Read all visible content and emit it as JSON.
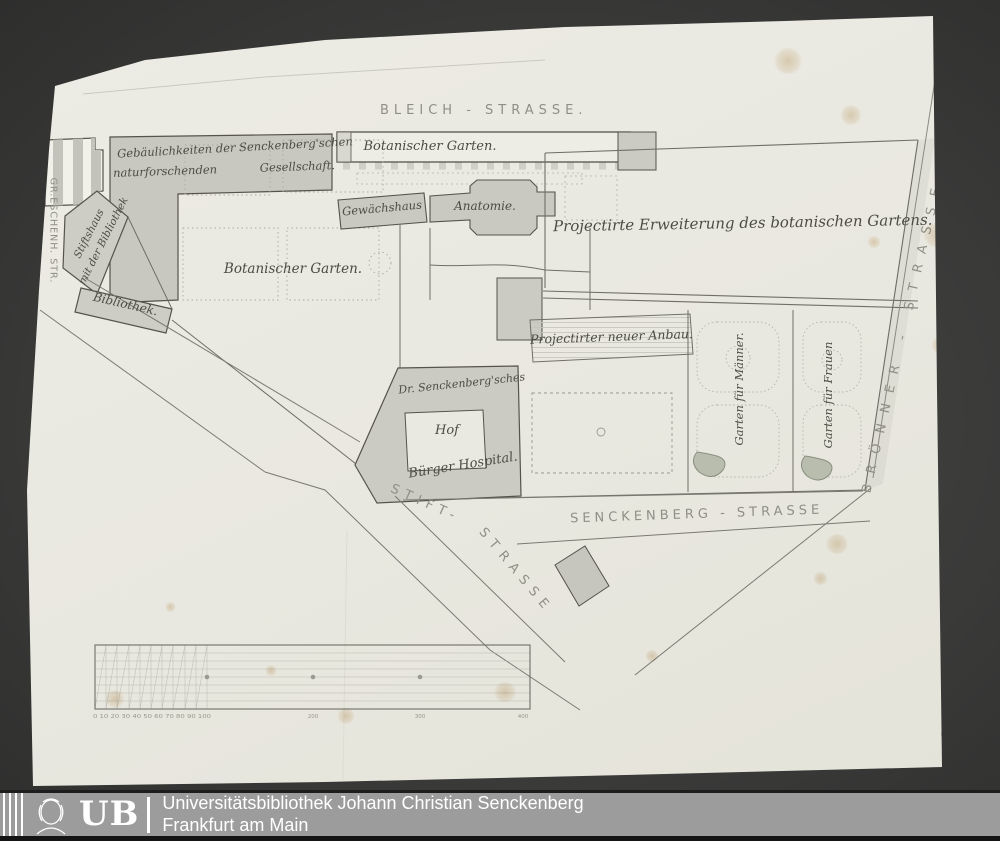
{
  "map": {
    "streets": {
      "bleich": "BLEICH - STRASSE.",
      "gr_eschenheimer": "GR.ESCHENH. STR.",
      "stift_part1": "STIFT-",
      "stift_part2": "STRASSE",
      "senckenberg": "SENCKENBERG - STRASSE",
      "broenner": "BRÖNNER - STRASSE"
    },
    "labels": {
      "botanischer_garten_strip": "Botanischer Garten.",
      "gesellschaft_line1": "Gebäulichkeiten der Senckenberg'schen",
      "gesellschaft_line2_left": "naturforschenden",
      "gesellschaft_line2_right": "Gesellschaft.",
      "stiftshaus_line1": "Stiftshaus",
      "stiftshaus_line2": "mit der Bibliothek",
      "bibliothek": "Bibliothek.",
      "botanischer_garten_main": "Botanischer Garten.",
      "gewaechshaus": "Gewächshaus",
      "anatomie": "Anatomie.",
      "erweiterung": "Projectirte Erweiterung des botanischen Gartens.",
      "anbau": "Projectirter neuer Anbau.",
      "dr_senckenberg": "Dr. Senckenberg'sches",
      "hof": "Hof",
      "buerger_hospital": "Bürger Hospital.",
      "garten_maenner": "Garten für Männer.",
      "garten_frauen": "Garten für Frauen"
    },
    "scale_bar": {
      "minor": "0 10 20 30 40 50 60 70 80 90 100",
      "t200": "200",
      "t300": "300",
      "t400": "400"
    },
    "page_number": "10"
  },
  "footer": {
    "logo_text": "UB",
    "line1": "Universitätsbibliothek Johann Christian Senckenberg",
    "line2": "Frankfurt am Main"
  },
  "colors": {
    "mat_background": "#3a3a39",
    "paper": "#e9e8e0",
    "building_fill": "#c9c9c1",
    "line_ink": "#6f6f67",
    "footer_bar": "#9c9c9c",
    "footer_text": "#ffffff",
    "foxing": "#bb8a40"
  }
}
